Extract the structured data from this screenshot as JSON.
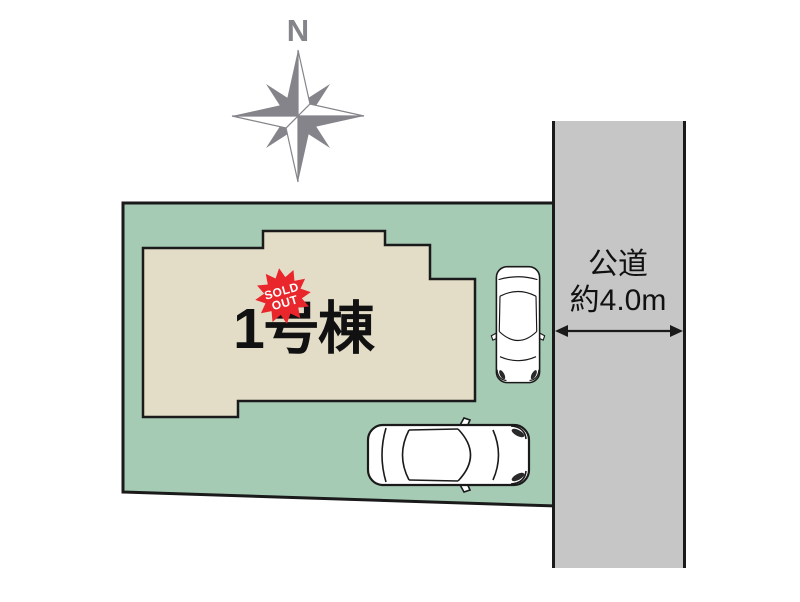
{
  "compass": {
    "north_label": "N"
  },
  "site": {
    "building_label": "1号棟",
    "sold_out_badge": {
      "line1": "SOLD",
      "line2": "OUT"
    }
  },
  "road": {
    "name": "公道",
    "width_label": "約4.0m"
  },
  "colors": {
    "plot_green": "#a6cbb5",
    "building_beige": "#e3dcc7",
    "road_gray": "#c6c6c6",
    "outline_dark": "#1a1a1a",
    "compass_gray": "#84848a",
    "badge_red": "#e8262b",
    "text_black": "#111111",
    "car_white": "#ffffff"
  }
}
